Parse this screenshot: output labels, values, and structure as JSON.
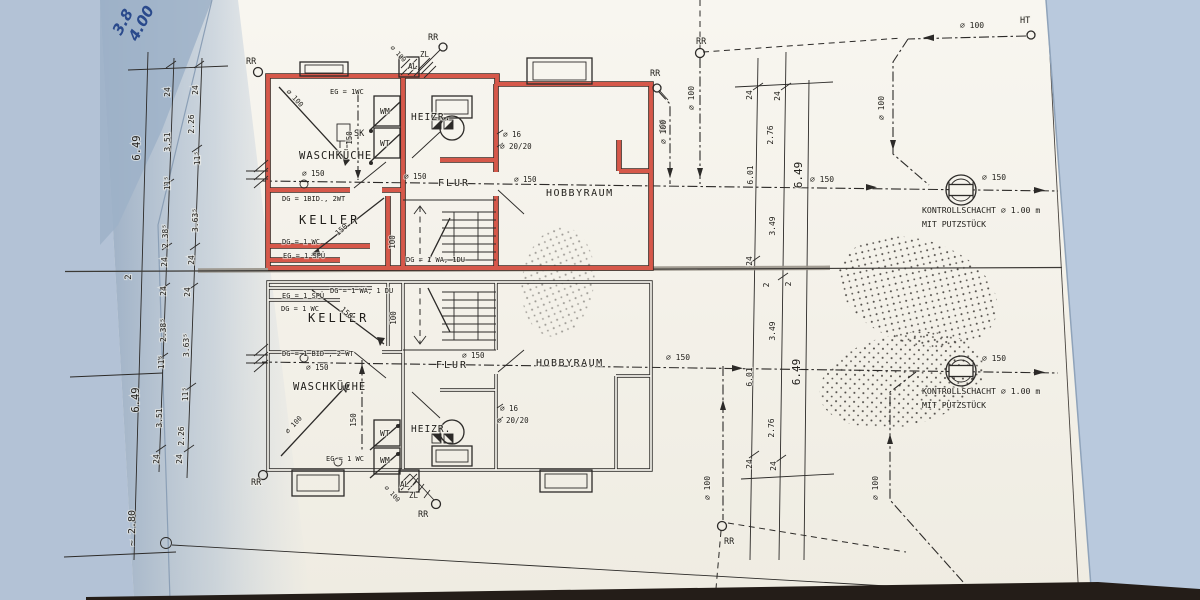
{
  "colors": {
    "paper": "#f6f4ec",
    "background_left": "#a9b9cc",
    "background_right": "#b9c9dd",
    "ink": "#2c2a28",
    "highlight_red": "#d6584a",
    "table_edge": "#241d18",
    "pen_blue": "#2a4a8c"
  },
  "handwriting": [
    {
      "t": "3.8",
      "x": 121,
      "y": 36,
      "r": -62,
      "s": 15
    },
    {
      "t": "4.00",
      "x": 137,
      "y": 42,
      "r": -62,
      "s": 15
    }
  ],
  "labels": {
    "upper_plan": [
      {
        "t": "RR",
        "x": 246,
        "y": 64,
        "s": 8.5
      },
      {
        "t": "∅ 100",
        "x": 286,
        "y": 92,
        "r": 47,
        "s": 7
      },
      {
        "t": "EG = 1WC",
        "x": 330,
        "y": 94,
        "s": 7
      },
      {
        "t": "150",
        "x": 352,
        "y": 138,
        "r": -90,
        "s": 7.5
      },
      {
        "t": "WM",
        "x": 380,
        "y": 114,
        "s": 8
      },
      {
        "t": "WT",
        "x": 380,
        "y": 146,
        "s": 8
      },
      {
        "t": "SK",
        "x": 354,
        "y": 136,
        "s": 8.5
      },
      {
        "t": "WASCHKÜCHE",
        "x": 299,
        "y": 159,
        "s": 10.5,
        "ls": 1
      },
      {
        "t": "∅ 150",
        "x": 302,
        "y": 176,
        "s": 7.5
      },
      {
        "t": "DG = 1BID., 2WT",
        "x": 282,
        "y": 201,
        "s": 7
      },
      {
        "t": "KELLER",
        "x": 299,
        "y": 224,
        "s": 12,
        "ls": 3
      },
      {
        "t": "DG = 1 WC",
        "x": 282,
        "y": 244,
        "s": 7
      },
      {
        "t": "EG = 1 SPÜ",
        "x": 283,
        "y": 258,
        "s": 7
      },
      {
        "t": "150",
        "x": 338,
        "y": 236,
        "r": -42,
        "s": 7.5
      },
      {
        "t": "100",
        "x": 395,
        "y": 242,
        "r": -90,
        "s": 7.5
      },
      {
        "t": "DG = 1 WA, 1DU",
        "x": 406,
        "y": 262,
        "s": 7
      },
      {
        "t": "RR",
        "x": 428,
        "y": 40,
        "s": 8.5
      },
      {
        "t": "ZL",
        "x": 420,
        "y": 57,
        "s": 7.5
      },
      {
        "t": "AL",
        "x": 408,
        "y": 69,
        "s": 7.5
      },
      {
        "t": "∅ 100",
        "x": 390,
        "y": 48,
        "r": 47,
        "s": 6.5
      },
      {
        "t": "HEIZR.",
        "x": 411,
        "y": 120,
        "s": 9.5,
        "ls": 1
      },
      {
        "t": "∅ 16",
        "x": 503,
        "y": 137,
        "s": 7.5
      },
      {
        "t": "∅ 20/20",
        "x": 500,
        "y": 149,
        "s": 7.5
      },
      {
        "t": "∅ 150",
        "x": 404,
        "y": 179,
        "s": 7.5
      },
      {
        "t": "FLUR",
        "x": 438,
        "y": 186,
        "s": 10,
        "ls": 2
      },
      {
        "t": "∅ 150",
        "x": 514,
        "y": 182,
        "s": 7.5
      },
      {
        "t": "HOBBYRAUM",
        "x": 546,
        "y": 196,
        "s": 10,
        "ls": 1.5
      },
      {
        "t": "RR",
        "x": 650,
        "y": 76,
        "s": 8.5
      },
      {
        "t": "100",
        "x": 665,
        "y": 126,
        "r": -90,
        "s": 7.5
      }
    ],
    "lower_plan": [
      {
        "t": "EG = 1 SPÜ",
        "x": 282,
        "y": 298,
        "s": 7
      },
      {
        "t": "DG = 1 WC",
        "x": 281,
        "y": 311,
        "s": 7
      },
      {
        "t": "DG = 1 WA, 1 DU",
        "x": 330,
        "y": 293,
        "s": 7
      },
      {
        "t": "KELLER",
        "x": 308,
        "y": 322,
        "s": 12,
        "ls": 3
      },
      {
        "t": "150",
        "x": 340,
        "y": 310,
        "r": 42,
        "s": 7.5
      },
      {
        "t": "100",
        "x": 396,
        "y": 318,
        "r": -90,
        "s": 7.5
      },
      {
        "t": "DG = 1 BID , 2 WT",
        "x": 282,
        "y": 356,
        "s": 7
      },
      {
        "t": "∅ 150",
        "x": 306,
        "y": 370,
        "s": 7.5
      },
      {
        "t": "FLUR",
        "x": 436,
        "y": 368,
        "s": 10,
        "ls": 2
      },
      {
        "t": "∅ 150",
        "x": 462,
        "y": 358,
        "s": 7.5
      },
      {
        "t": "HOBBYRAUM",
        "x": 536,
        "y": 366,
        "s": 10,
        "ls": 1.5
      },
      {
        "t": "WASCHKÜCHE",
        "x": 293,
        "y": 390,
        "s": 10.5,
        "ls": 1
      },
      {
        "t": "∅ 100",
        "x": 288,
        "y": 434,
        "r": -47,
        "s": 7
      },
      {
        "t": "150",
        "x": 356,
        "y": 420,
        "r": -90,
        "s": 7.5
      },
      {
        "t": "WT",
        "x": 380,
        "y": 436,
        "s": 8
      },
      {
        "t": "WM",
        "x": 380,
        "y": 463,
        "s": 8
      },
      {
        "t": "HEIZR.",
        "x": 411,
        "y": 432,
        "s": 9.5,
        "ls": 1
      },
      {
        "t": "∅ 16",
        "x": 500,
        "y": 411,
        "s": 7.5
      },
      {
        "t": "∅ 20/20",
        "x": 497,
        "y": 423,
        "s": 7.5
      },
      {
        "t": "EG = 1 WC",
        "x": 326,
        "y": 461,
        "s": 7
      },
      {
        "t": "RR",
        "x": 251,
        "y": 485,
        "s": 8.5
      },
      {
        "t": "AL.",
        "x": 400,
        "y": 487,
        "s": 7.5
      },
      {
        "t": "ZL",
        "x": 409,
        "y": 498,
        "s": 7.5
      },
      {
        "t": "∅ 100",
        "x": 384,
        "y": 488,
        "r": 47,
        "s": 6.5
      },
      {
        "t": "RR",
        "x": 418,
        "y": 517,
        "s": 8.5
      }
    ],
    "left_dims": [
      {
        "t": "6.49",
        "x": 140,
        "y": 148,
        "r": -90,
        "s": 10.5
      },
      {
        "t": "24",
        "x": 170,
        "y": 92,
        "r": -90
      },
      {
        "t": "3.51",
        "x": 170,
        "y": 142,
        "r": -90
      },
      {
        "t": "11⁵",
        "x": 170,
        "y": 183,
        "r": -90
      },
      {
        "t": "2.38⁵",
        "x": 168,
        "y": 236,
        "r": -90
      },
      {
        "t": "24",
        "x": 167,
        "y": 262,
        "r": -90
      },
      {
        "t": "24",
        "x": 198,
        "y": 90,
        "r": -90
      },
      {
        "t": "2.26",
        "x": 194,
        "y": 124,
        "r": -90
      },
      {
        "t": "11⁵",
        "x": 200,
        "y": 158,
        "r": -90
      },
      {
        "t": "3.63⁵",
        "x": 198,
        "y": 220,
        "r": -90
      },
      {
        "t": "24",
        "x": 194,
        "y": 260,
        "r": -90
      },
      {
        "t": "2",
        "x": 131,
        "y": 277,
        "r": -90,
        "s": 9
      },
      {
        "t": "24",
        "x": 166,
        "y": 291,
        "r": -90
      },
      {
        "t": "2.38⁵",
        "x": 166,
        "y": 330,
        "r": -90
      },
      {
        "t": "11⁵",
        "x": 164,
        "y": 362,
        "r": -90
      },
      {
        "t": "3.51",
        "x": 162,
        "y": 418,
        "r": -90
      },
      {
        "t": "24",
        "x": 159,
        "y": 459,
        "r": -90
      },
      {
        "t": "24",
        "x": 190,
        "y": 292,
        "r": -90
      },
      {
        "t": "3.63⁵",
        "x": 189,
        "y": 345,
        "r": -90
      },
      {
        "t": "11⁵",
        "x": 188,
        "y": 394,
        "r": -90
      },
      {
        "t": "2.26",
        "x": 184,
        "y": 436,
        "r": -90
      },
      {
        "t": "24",
        "x": 182,
        "y": 459,
        "r": -90
      },
      {
        "t": "6.49",
        "x": 139,
        "y": 400,
        "r": -90,
        "s": 10.5
      },
      {
        "t": "~ 2.80",
        "x": 135,
        "y": 528,
        "r": -90,
        "s": 10
      }
    ],
    "right_dims": [
      {
        "t": "24",
        "x": 752,
        "y": 95,
        "r": -90
      },
      {
        "t": "24",
        "x": 780,
        "y": 96,
        "r": -90
      },
      {
        "t": "2.76",
        "x": 773,
        "y": 135,
        "r": -90
      },
      {
        "t": "6.01",
        "x": 753,
        "y": 175,
        "r": -90
      },
      {
        "t": "6.49",
        "x": 802,
        "y": 175,
        "r": -90,
        "s": 11
      },
      {
        "t": "3.49",
        "x": 775,
        "y": 226,
        "r": -90
      },
      {
        "t": "24",
        "x": 752,
        "y": 261,
        "r": -90
      },
      {
        "t": "2",
        "x": 769,
        "y": 285,
        "r": -90
      },
      {
        "t": "2",
        "x": 791,
        "y": 284,
        "r": -90
      },
      {
        "t": "3.49",
        "x": 775,
        "y": 331,
        "r": -90
      },
      {
        "t": "6.01",
        "x": 752,
        "y": 377,
        "r": -90
      },
      {
        "t": "6.49",
        "x": 800,
        "y": 372,
        "r": -90,
        "s": 11
      },
      {
        "t": "2.76",
        "x": 774,
        "y": 428,
        "r": -90
      },
      {
        "t": "24",
        "x": 752,
        "y": 464,
        "r": -90
      },
      {
        "t": "24",
        "x": 776,
        "y": 466,
        "r": -90
      }
    ],
    "site": [
      {
        "t": "RR",
        "x": 696,
        "y": 44,
        "s": 8.5
      },
      {
        "t": "∅ 100",
        "x": 694,
        "y": 98,
        "r": -90
      },
      {
        "t": "∅ 100",
        "x": 666,
        "y": 132,
        "r": -90
      },
      {
        "t": "∅ 100",
        "x": 884,
        "y": 108,
        "r": -90
      },
      {
        "t": "∅ 100",
        "x": 960,
        "y": 28,
        "s": 8
      },
      {
        "t": "HT",
        "x": 1020,
        "y": 23,
        "s": 8.5
      },
      {
        "t": "∅ 150",
        "x": 810,
        "y": 182,
        "s": 8
      },
      {
        "t": "∅ 150",
        "x": 982,
        "y": 180,
        "s": 8
      },
      {
        "t": "KONTROLLSCHACHT ∅ 1.00 m",
        "x": 922,
        "y": 213,
        "s": 8.2
      },
      {
        "t": "MIT PUTZSTÜCK",
        "x": 922,
        "y": 227,
        "s": 8.2
      },
      {
        "t": "∅ 150",
        "x": 666,
        "y": 360,
        "s": 8
      },
      {
        "t": "∅ 150",
        "x": 982,
        "y": 361,
        "s": 8
      },
      {
        "t": "KONTROLLSCHACHT ∅ 1.00 m",
        "x": 922,
        "y": 394,
        "s": 8.2
      },
      {
        "t": "MIT PUTZSTÜCK",
        "x": 922,
        "y": 408,
        "s": 8.2
      },
      {
        "t": "∅ 100",
        "x": 710,
        "y": 488,
        "r": -90
      },
      {
        "t": "RR",
        "x": 724,
        "y": 544,
        "s": 8.5
      },
      {
        "t": "∅ 100",
        "x": 878,
        "y": 488,
        "r": -90
      }
    ]
  }
}
